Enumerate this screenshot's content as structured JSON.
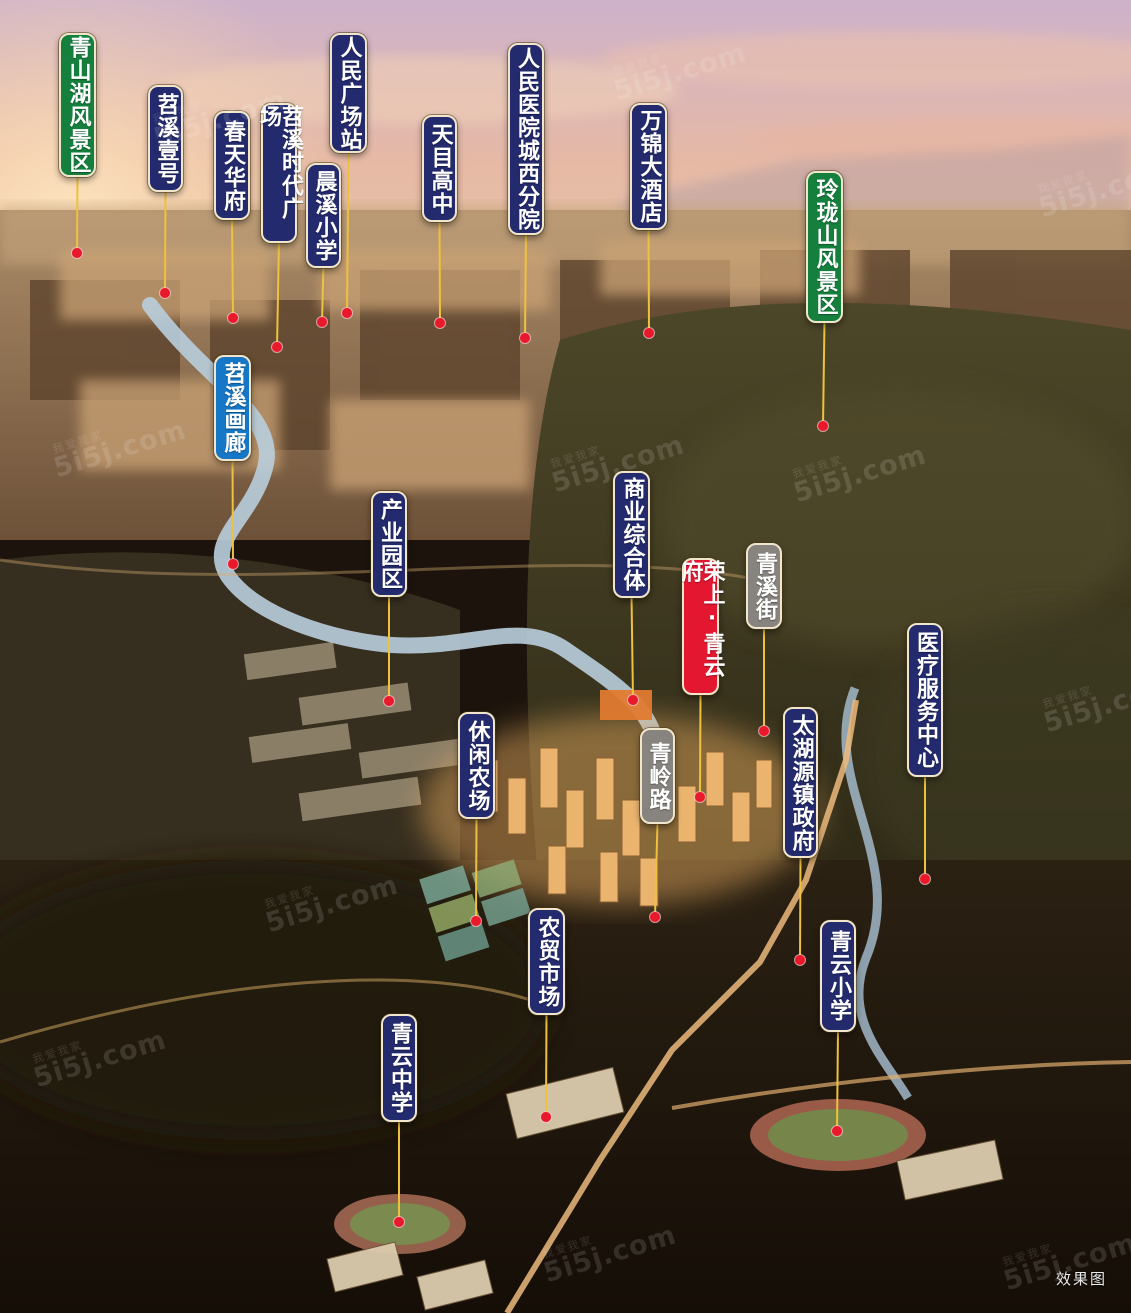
{
  "scene": {
    "corner_note": "效果图"
  },
  "watermark": {
    "text": "5i5j.com",
    "subtext": "我爱我家",
    "positions": [
      {
        "x": 150,
        "y": 95
      },
      {
        "x": 610,
        "y": 48
      },
      {
        "x": 1035,
        "y": 165
      },
      {
        "x": 50,
        "y": 425
      },
      {
        "x": 548,
        "y": 440
      },
      {
        "x": 1040,
        "y": 680
      },
      {
        "x": 262,
        "y": 880
      },
      {
        "x": 30,
        "y": 1035
      },
      {
        "x": 540,
        "y": 1230
      },
      {
        "x": 1000,
        "y": 1238
      },
      {
        "x": 790,
        "y": 450
      }
    ]
  },
  "colors": {
    "navy": "#232a6d",
    "green": "#15803d",
    "red": "#e41730",
    "gray": "#87847f",
    "blue": "#1577c5",
    "line": "#eec13e",
    "dot": "#e8192b"
  },
  "markers": [
    {
      "id": "qingshanhu-scenic",
      "label": "青山湖风景区",
      "type": "green",
      "x": 59,
      "y": 33,
      "w": 37,
      "h": 144,
      "dot": [
        77,
        253
      ]
    },
    {
      "id": "tiaoxi-no1",
      "label": "苕溪壹号",
      "type": "navy",
      "x": 148,
      "y": 85,
      "w": 35,
      "h": 107,
      "dot": [
        165,
        293
      ]
    },
    {
      "id": "chuntian-huafu",
      "label": "春天华府",
      "type": "navy",
      "x": 214,
      "y": 111,
      "w": 36,
      "h": 109,
      "dot": [
        233,
        318
      ]
    },
    {
      "id": "tiaoxi-times-plaza",
      "label": "苕溪时代广场",
      "type": "navy",
      "x": 261,
      "y": 103,
      "w": 36,
      "h": 140,
      "dot": [
        277,
        347
      ]
    },
    {
      "id": "renmin-square-station",
      "label": "人民广场站",
      "type": "navy",
      "x": 330,
      "y": 33,
      "w": 37,
      "h": 120,
      "dot": [
        347,
        313
      ]
    },
    {
      "id": "chenxi-primary-school",
      "label": "晨溪小学",
      "type": "navy",
      "x": 306,
      "y": 163,
      "w": 35,
      "h": 105,
      "dot": [
        322,
        322
      ]
    },
    {
      "id": "tianmu-high-school",
      "label": "天目高中",
      "type": "navy",
      "x": 422,
      "y": 115,
      "w": 35,
      "h": 107,
      "dot": [
        440,
        323
      ]
    },
    {
      "id": "renmin-hospital-west-branch",
      "label": "人民医院城西分院",
      "type": "navy",
      "x": 508,
      "y": 43,
      "w": 36,
      "h": 192,
      "dot": [
        525,
        338
      ]
    },
    {
      "id": "wanjin-hotel",
      "label": "万锦大酒店",
      "type": "navy",
      "x": 630,
      "y": 103,
      "w": 37,
      "h": 127,
      "dot": [
        649,
        333
      ]
    },
    {
      "id": "linglongshan-scenic",
      "label": "玲珑山风景区",
      "type": "green",
      "x": 806,
      "y": 171,
      "w": 37,
      "h": 152,
      "dot": [
        823,
        426
      ]
    },
    {
      "id": "tiaoxi-gallery",
      "label": "苕溪画廊",
      "type": "blue",
      "x": 214,
      "y": 355,
      "w": 37,
      "h": 106,
      "dot": [
        233,
        564
      ]
    },
    {
      "id": "industrial-park",
      "label": "产业园区",
      "type": "navy",
      "x": 371,
      "y": 491,
      "w": 36,
      "h": 106,
      "dot": [
        389,
        701
      ]
    },
    {
      "id": "commercial-complex",
      "label": "商业综合体",
      "type": "navy",
      "x": 613,
      "y": 471,
      "w": 37,
      "h": 127,
      "dot": [
        633,
        700
      ]
    },
    {
      "id": "rongshang-qingyunfu",
      "label": "荣上·青云府",
      "type": "red",
      "x": 682,
      "y": 558,
      "w": 37,
      "h": 137,
      "dot": [
        700,
        797
      ]
    },
    {
      "id": "qingxi-street",
      "label": "青溪街",
      "type": "gray",
      "x": 746,
      "y": 543,
      "w": 36,
      "h": 86,
      "dot": [
        764,
        731
      ]
    },
    {
      "id": "qingling-road",
      "label": "青岭路",
      "type": "gray",
      "x": 640,
      "y": 728,
      "w": 35,
      "h": 96,
      "dot": [
        655,
        917
      ]
    },
    {
      "id": "taihuyuan-town-gov",
      "label": "太湖源镇政府",
      "type": "navy",
      "x": 783,
      "y": 707,
      "w": 35,
      "h": 151,
      "dot": [
        800,
        960
      ]
    },
    {
      "id": "medical-service-center",
      "label": "医疗服务中心",
      "type": "navy",
      "x": 907,
      "y": 623,
      "w": 36,
      "h": 154,
      "dot": [
        925,
        879
      ]
    },
    {
      "id": "leisure-farm",
      "label": "休闲农场",
      "type": "navy",
      "x": 458,
      "y": 712,
      "w": 37,
      "h": 107,
      "dot": [
        476,
        921
      ]
    },
    {
      "id": "farmers-market",
      "label": "农贸市场",
      "type": "navy",
      "x": 528,
      "y": 908,
      "w": 37,
      "h": 107,
      "dot": [
        546,
        1117
      ]
    },
    {
      "id": "qingyun-primary-school",
      "label": "青云小学",
      "type": "navy",
      "x": 820,
      "y": 920,
      "w": 36,
      "h": 112,
      "dot": [
        837,
        1131
      ]
    },
    {
      "id": "qingyun-middle-school",
      "label": "青云中学",
      "type": "navy",
      "x": 381,
      "y": 1014,
      "w": 36,
      "h": 108,
      "dot": [
        399,
        1222
      ]
    }
  ]
}
